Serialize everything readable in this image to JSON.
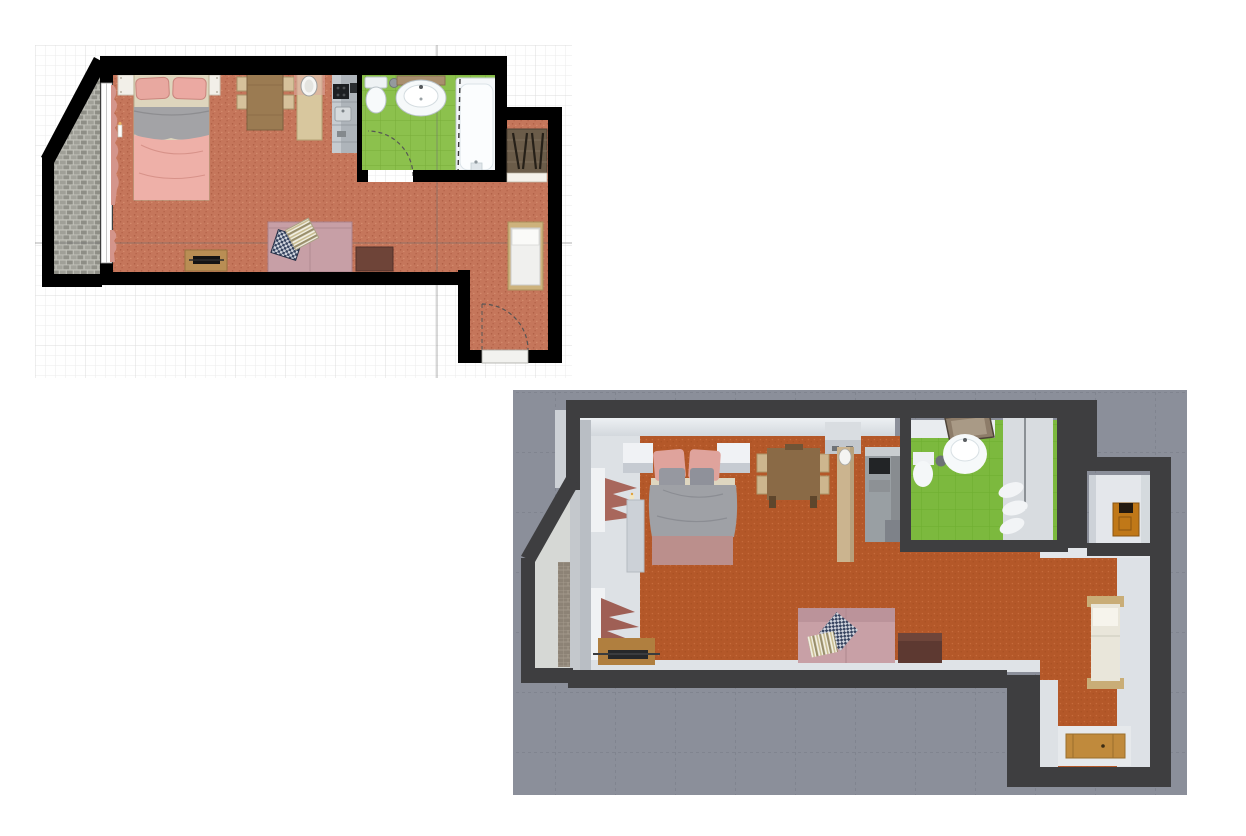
{
  "page": {
    "title": "Apartment floor plan — 2D plan and 3D aerial view",
    "background_color": "#ffffff"
  },
  "plan2d": {
    "label": "2D floor plan on drawing grid",
    "grid": {
      "background": "#ffffff",
      "minor_line": "#ebebeb",
      "major_line": "#dcdcdc",
      "axis_line": "#6f6f6f"
    },
    "wall_color": "#000000",
    "rooms": [
      {
        "name": "living-bedroom",
        "floor": "terracotta",
        "floor_color": "#c5765b",
        "furniture": [
          "double-bed",
          "nightstand-left",
          "nightstand-right",
          "dining-table",
          "dining-chairs",
          "wall-cabinet",
          "wardrobe-with-mirror",
          "sofa",
          "checkered-pillow",
          "striped-pillow",
          "coffee-table",
          "tv-stand",
          "tv",
          "window-curtain",
          "candle"
        ]
      },
      {
        "name": "kitchen-strip",
        "floor_color": "#c5765b",
        "furniture": [
          "kitchen-counter",
          "cooktop",
          "kitchen-sink"
        ]
      },
      {
        "name": "bathroom",
        "floor": "green tile",
        "floor_color": "#8cc14d",
        "furniture": [
          "toilet",
          "washbasin",
          "waste-bin",
          "bathtub",
          "shower-screen",
          "bathroom-door-arc"
        ]
      },
      {
        "name": "entry-hall",
        "floor_color": "#c5765b",
        "furniture": [
          "single-bed",
          "coat-closet",
          "door-threshold",
          "entry-door-arc"
        ]
      },
      {
        "name": "balcony",
        "floor": "stone tiles",
        "floor_color": "#9b9b93",
        "furniture": []
      }
    ]
  },
  "view3d": {
    "label": "3D aerial view of the same apartment",
    "background_color": "#8b8f9a",
    "grid_line_color": "#757984",
    "wall_color": "#3e3e40",
    "wall_face_color": "#e2e6ea",
    "floor_color": "#b45829",
    "bathroom_floor_color": "#7cb93e",
    "balcony_color": "#d6d8d5",
    "furniture": [
      "double-bed",
      "nightstand-left",
      "nightstand-right",
      "wardrobe-panel",
      "candle",
      "dining-table",
      "dining-chairs",
      "wall-cabinet",
      "column-wardrobe-mirror",
      "kitchen-counter",
      "cooktop",
      "toilet",
      "waste-bin",
      "washbasin",
      "mirror",
      "shower-cabin",
      "towels",
      "niche-cabinet",
      "single-bed",
      "entry-door",
      "sofa",
      "checkered-pillow",
      "striped-pillow",
      "coffee-table",
      "tv-stand",
      "curtains"
    ]
  },
  "colors": {
    "bed_pillow_pink": "#e8a8a0",
    "bed_duvet_gray": "#9fa1a6",
    "bed_duvet_pink": "#eeb0a8",
    "sofa_pink": "#c79fa6",
    "table_wood": "#9b7b52",
    "chair_wood": "#d6c19b",
    "tv_stand_wood": "#b98e54",
    "coffee_table_brown": "#6e4438",
    "coat_closet_wood": "#6b5c49",
    "niche_cabinet_orange": "#c07818",
    "door_wood": "#c08a3c",
    "curtain_pink": "#d4958b"
  }
}
